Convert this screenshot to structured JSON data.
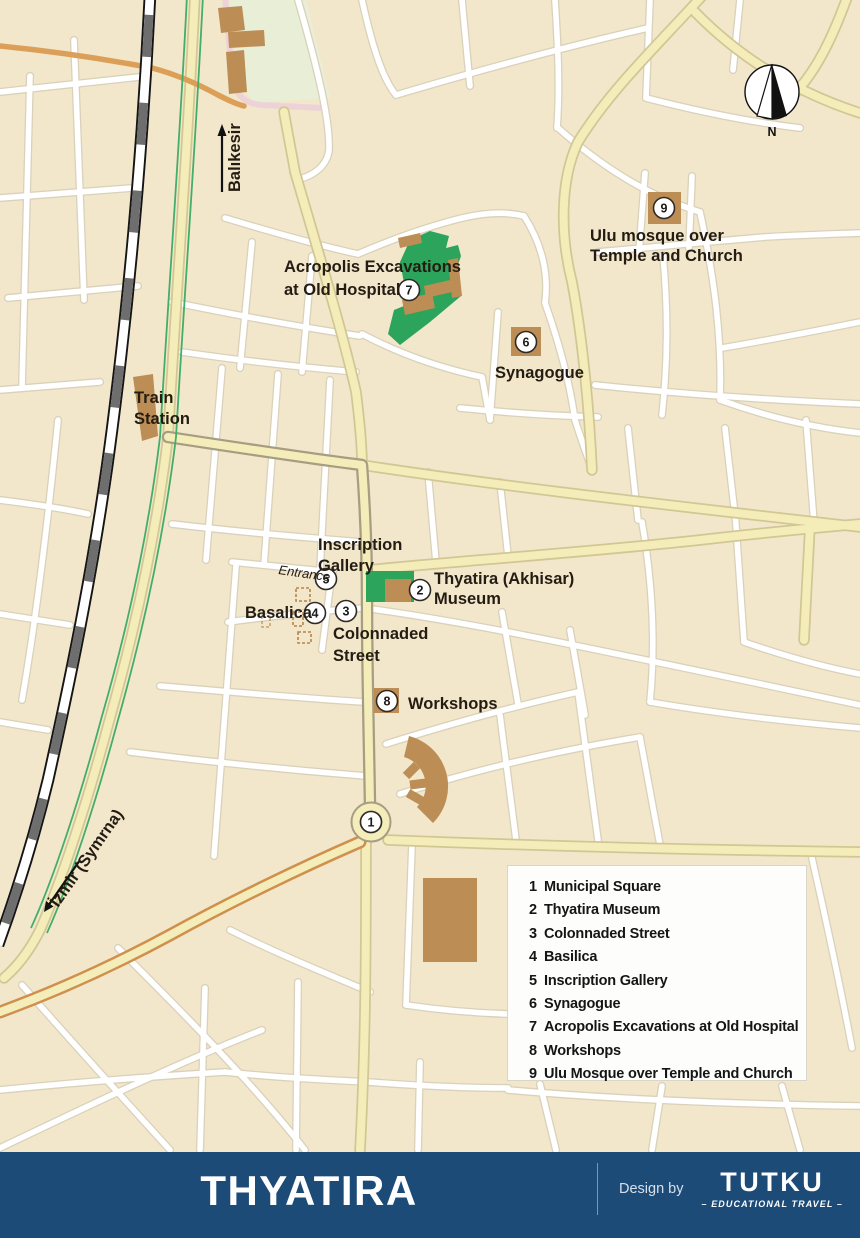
{
  "colors": {
    "map_bg": "#f2e7cb",
    "street_fill": "#ffffff",
    "street_casing": "#d9d1ba",
    "road_yellow": "#f4edb9",
    "road_yellow_casing": "#d2c794",
    "road_main_casing": "#a69d83",
    "road_orange": "#db9f58",
    "road_orange_casing": "#cf8f4d",
    "road_pink": "#edd3d7",
    "rail_black": "#151515",
    "rail_gray": "#6e6e6e",
    "rail_white": "#ffffff",
    "green_strip": "#44ae68",
    "park_fill": "#e9efd7",
    "excavation_green": "#2ca45b",
    "building": "#bc8d55",
    "marker_fill": "#ffffff",
    "marker_stroke": "#2e2a26",
    "label": "#241c12",
    "legend_bg": "#fdfdfc",
    "legend_border": "#d9d5c9",
    "legend_text": "#151515",
    "footer_bg": "#1d4b78",
    "footer_text": "#ffffff",
    "footer_muted": "#d7e0ea",
    "divider": "#7e95ae"
  },
  "map": {
    "compass_n": "N",
    "labels": {
      "balikesir": "Balıkesir",
      "izmir": "İzmir (Symrna)",
      "train_1": "Train",
      "train_2": "Station",
      "acropolis_1": "Acropolis Excavations",
      "acropolis_2": "at Old Hospital",
      "ulu_1": "Ulu mosque over",
      "ulu_2": "Temple and Church",
      "synagogue": "Synagogue",
      "inscription_1": "Inscription",
      "inscription_2": "Gallery",
      "entrance": "Entrance",
      "museum_1": "Thyatira (Akhisar)",
      "museum_2": "Museum",
      "basalica": "Basalica",
      "colonnaded_1": "Colonnaded",
      "colonnaded_2": "Street",
      "workshops": "Workshops"
    },
    "markers": {
      "m1": "1",
      "m2": "2",
      "m3": "3",
      "m4": "4",
      "m5": "5",
      "m6": "6",
      "m7": "7",
      "m8": "8",
      "m9": "9"
    }
  },
  "legend": {
    "items": [
      {
        "num": "1",
        "label": "Municipal Square"
      },
      {
        "num": "2",
        "label": "Thyatira Museum"
      },
      {
        "num": "3",
        "label": "Colonnaded Street"
      },
      {
        "num": "4",
        "label": "Basilica"
      },
      {
        "num": "5",
        "label": "Inscription Gallery"
      },
      {
        "num": "6",
        "label": "Synagogue"
      },
      {
        "num": "7",
        "label": "Acropolis Excavations at Old Hospital"
      },
      {
        "num": "8",
        "label": "Workshops"
      },
      {
        "num": "9",
        "label": "Ulu Mosque over Temple and Church"
      }
    ]
  },
  "footer": {
    "title": "THYATIRA",
    "design_by": "Design by",
    "brand": "TUTKU",
    "brand_sub": "– EDUCATIONAL TRAVEL –"
  }
}
